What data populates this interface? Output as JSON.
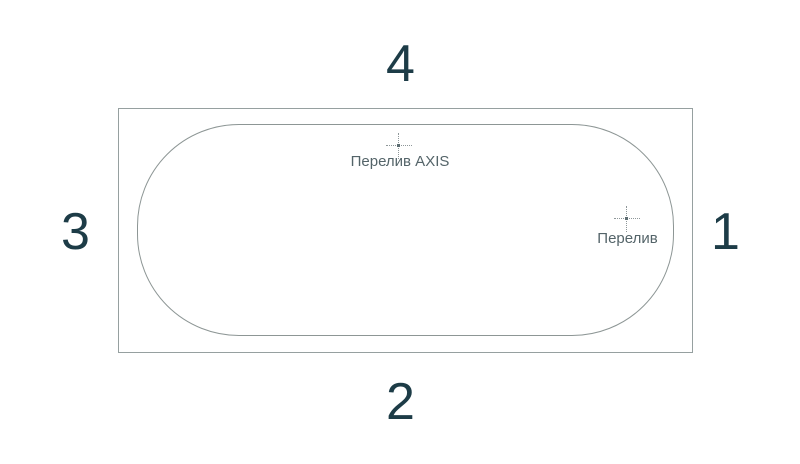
{
  "figure": {
    "description": "bathtub-top-view-technical-diagram",
    "side_labels": {
      "top": "4",
      "bottom": "2",
      "left": "3",
      "right": "1"
    },
    "markers": {
      "axis_overflow": {
        "label": "Перелив AXIS",
        "icon": "center-mark-crosshair-icon"
      },
      "overflow": {
        "label": "Перелив",
        "icon": "center-mark-crosshair-icon"
      }
    },
    "colors": {
      "number_label": "#1d3c47",
      "marker_label": "#546469",
      "outer_outline": "#96a0a0",
      "tub_outline": "#8d9695",
      "background": "#ffffff"
    }
  }
}
